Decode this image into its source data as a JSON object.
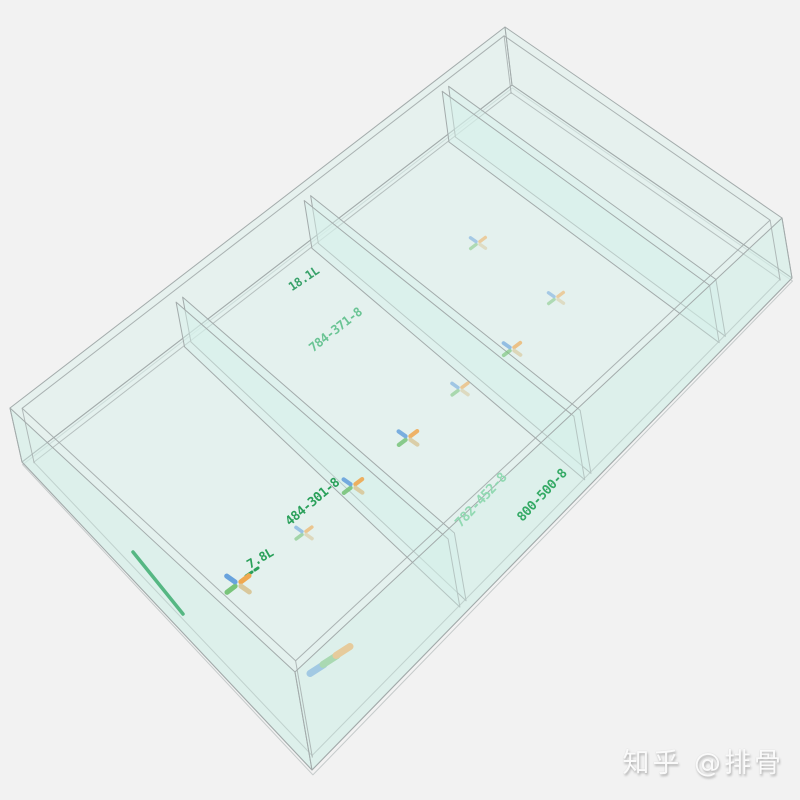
{
  "scene": {
    "description": "3D wireframe preview of a glass sump tank (4 compartments, 3 partition panels) viewed from above",
    "background": "#f2f2f2",
    "glass_edge_color": "#a3abab",
    "glass_fill_color": "#d2eee8",
    "label_color": "#2aa05a"
  },
  "labels": [
    {
      "kind": "volume",
      "text": "18.1L"
    },
    {
      "kind": "panel-dimension",
      "text": "784-371-8"
    },
    {
      "kind": "panel-dimension",
      "text": "484-301-8"
    },
    {
      "kind": "panel-dimension",
      "text": "782-452-8"
    },
    {
      "kind": "panel-dimension",
      "text": "800-500-8"
    },
    {
      "kind": "volume",
      "text": "7.8L"
    }
  ],
  "markers": {
    "icon": "axis-cross-icon",
    "arm_colors": [
      "#f0a850",
      "#d9c89c",
      "#79c47a",
      "#68a3dd"
    ],
    "points": [
      {
        "x": 478,
        "y": 243,
        "s": 0.8,
        "o": 0.5
      },
      {
        "x": 556,
        "y": 298,
        "s": 0.8,
        "o": 0.5
      },
      {
        "x": 512,
        "y": 349,
        "s": 0.9,
        "o": 0.65
      },
      {
        "x": 460,
        "y": 389,
        "s": 0.85,
        "o": 0.55
      },
      {
        "x": 408,
        "y": 438,
        "s": 1.0,
        "o": 0.85
      },
      {
        "x": 353,
        "y": 486,
        "s": 1.0,
        "o": 0.9
      },
      {
        "x": 304,
        "y": 533,
        "s": 0.85,
        "o": 0.6
      },
      {
        "x": 238,
        "y": 584,
        "s": 1.2,
        "o": 1.0
      }
    ]
  },
  "origin_triad": {
    "icon": "xyz-axis-icon",
    "x": 330,
    "y": 660,
    "colors": [
      "#68a3dd",
      "#79c47a",
      "#f0a850"
    ]
  },
  "watermark": {
    "text": "知乎 @排骨"
  }
}
